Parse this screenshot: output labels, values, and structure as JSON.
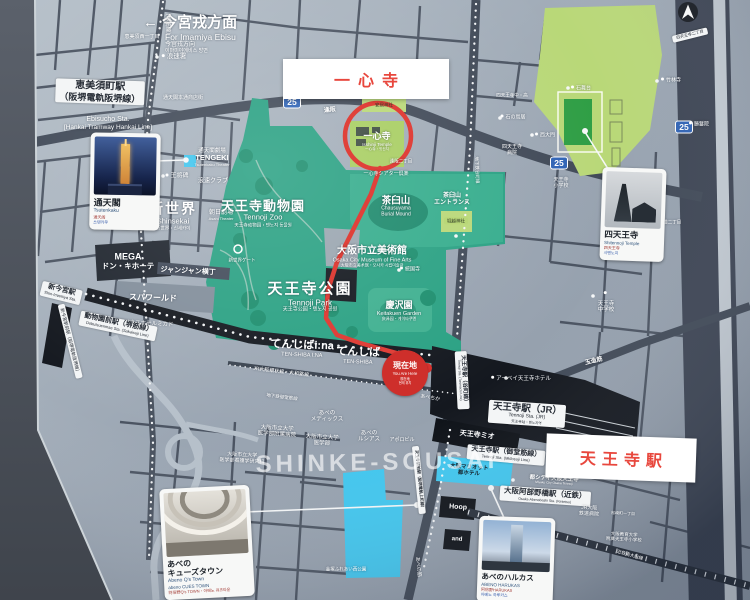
{
  "header": {
    "direction_jp": "← 今宮戎方面",
    "direction_en": "For Imamiya Ebisu",
    "direction_cn": "今宫戎方向",
    "direction_kr": "이마미야에비스 방면"
  },
  "callouts": {
    "isshinji": "一心寺",
    "tennoji": "天王寺駅"
  },
  "watermark": "SHINKE-SOUSAI",
  "route_shield": "25",
  "current_location": {
    "jp": "現在地",
    "en": "You Are Here",
    "cn": "现在地",
    "kr": "현재 위치"
  },
  "areas": {
    "zoo_jp": "天王寺動物園",
    "zoo_en": "Tennoji Zoo",
    "zoo_sub": "天王寺动物园・텐노지 동물원",
    "park_jp": "天王寺公園",
    "park_en": "Tennoji Park",
    "park_sub": "天王寺公园・텐노지 공원",
    "museum_jp": "大阪市立美術館",
    "museum_en": "Osaka City Museum of Fine Arts",
    "museum_sub": "大阪市立美术馆・오사카 시립미술관",
    "keitakuen_jp": "慶沢園",
    "keitakuen_en": "Keitakuen Garden",
    "keitakuen_sub": "庆泽园・게이타쿠엔",
    "chausuyama_jp": "茶臼山",
    "chausuyama_en1": "Chausuyama",
    "chausuyama_en2": "Burial Mound",
    "chausu_entrance1": "茶臼山",
    "chausu_entrance2": "エントランス",
    "tenshiba_ina_jp": "てんしばi:na",
    "tenshiba_ina_en": "TEN-SHIBA I:NA",
    "tenshiba_jp": "てんしば",
    "tenshiba_en": "TEN-SHIBA",
    "isshinji_jp": "一心寺",
    "isshinji_en": "Isshinji Temple",
    "isshinji_sub": "一心寺・잇신지",
    "shinsekai_jp": "新世界",
    "shinsekai_en": "Shinsekai",
    "shinsekai_sub": "新世界・신세카이"
  },
  "stations": {
    "ebisucho_jp1": "恵美須町駅",
    "ebisucho_jp2": "（阪堺電軌阪堺線）",
    "ebisucho_en1": "Ebisucho Sta.",
    "ebisucho_en2": "[Hankai Tramway Hankai Line]",
    "shinimamiya_jp": "新今宮駅",
    "shinimamiya_en": "Shin-Imamiya Sta.",
    "dobutsuenmae_jp": "動物園前駅（堺筋線）",
    "dobutsuenmae_en": "Dobutsuenmae Sta. (Sakaisuji Line)",
    "shinimamiya_ekimae": "新今宮駅前駅（阪堺電軌阪堺線）",
    "tanimachi_jp": "天王寺駅（谷町線）",
    "tanimachi_en": "Tennoji Sta. (Tanimachi Line)",
    "jr_jp": "天王寺駅（JR）",
    "jr_en": "Tennoji Sta. (JR)",
    "jr_sub": "天王寺站・텐노지역",
    "midosuji_jp": "天王寺駅（御堂筋線）",
    "midosuji_en": "Tennoji Sta. (Midosuji Line)",
    "uemachi": "天王寺駅前駅（阪堺電軌上町線）",
    "abenobashi_jp": "大阪阿部野橋駅（近鉄）",
    "abenobashi_en": "Osaka-Abenobashi Sta. (Kintetsu)"
  },
  "railways": {
    "jr": "JR大阪環状線・大和路線",
    "midosuji": "地下鉄御堂筋線",
    "tanimachi": "地下鉄谷町線",
    "sakaisuji": "（堺筋線）",
    "kintetsu": "近鉄南大阪線"
  },
  "roads": {
    "osakazaka": "逢阪",
    "tamatsukuri": "玉造筋",
    "abenosuji": "あべの筋"
  },
  "pois": {
    "naniwa_police": "浪速署",
    "hondori": "通天閣本通商店街",
    "theater1": "通天閣劇場",
    "theater2": "TENGEKI",
    "theater3": "Tsutenkaku Theater",
    "osho": "王将碑",
    "naniwa_club": "浪速クラブ",
    "asahi_jp": "朝日劇場",
    "asahi_en": "Asahi Theater",
    "mega1": "MEGA",
    "mega2": "ドン・キホーテ",
    "janjan": "ジャンジャン横丁",
    "spaworld": "スパワールド",
    "business_hotel": "ビジネスホテルミカド",
    "shinsekai_gate": "新世界ゲート",
    "isshinji_theater": "一心寺シアター倶楽",
    "yasui": "安居神社",
    "horikoshi": "堀越神社",
    "tokokuji": "統国寺",
    "abechika": "あべちか",
    "abey": "アーベイ天王寺ホテル",
    "mio": "天王寺ミオ",
    "marriott1": "大阪マリオット",
    "marriott2": "都ホテル",
    "miyako_city_jp": "都シティ大阪天王寺",
    "miyako_city_en": "Miyako City Osaka Tennoji",
    "hoop": "Hoop",
    "and": "and",
    "medix1": "あべの",
    "medix2": "メディックス",
    "lucias1": "あべの",
    "lucias2": "ルシアス",
    "apollo": "アポロビル",
    "hospital1": "大阪市立大学",
    "hospital2": "医学部附属病院",
    "univ1": "大阪市立大学",
    "univ2": "医学部",
    "nursing1": "大阪市立大学",
    "nursing2": "医学部看護学研究科",
    "jr_hospital1": "JR大阪",
    "jr_hospital2": "鉄道病院",
    "kyoiku1": "大阪教育大学",
    "kyoiku2": "附属天王寺小学校",
    "kanazuka": "金塚ふれあい西公園",
    "ishibutai": "石舞台",
    "saidaimon": "西大門",
    "stone_torii": "石の鳥居",
    "shitennoji_hosp1": "四天王寺",
    "shitennoji_hosp2": "病院",
    "shitennoji_hs": "四天王寺中・高",
    "chikurinji": "竹林寺",
    "shomanin": "勝鬘院",
    "tennoji_jhs1": "天王寺",
    "tennoji_jhs2": "中学校",
    "tennoji_es1": "天王寺",
    "tennoji_es2": "小学校"
  },
  "blocks": {
    "ebisu_nishi": "恵美須西一丁目",
    "osaka2": "逢阪二丁目",
    "shitennoji2": "四天王寺二丁目",
    "daido2": "大道二丁目",
    "matsuzaki": "松崎町一丁目"
  },
  "cards": {
    "tsutenkaku": {
      "title": "通天閣",
      "en": "Tsutenkaku",
      "cn": "通天阁",
      "kr": "쓰텐카쿠"
    },
    "shitennoji": {
      "title": "四天王寺",
      "en": "Shitennoji Temple",
      "cn": "四天王寺",
      "kr": "시텐노지"
    },
    "qstown": {
      "title1": "あべの",
      "title2": "キューズタウン",
      "en1": "Abeno Q's Town",
      "en2": "abeno CUES TOWN",
      "sub": "阿倍野Q's TOWN・아베노 큐즈타운"
    },
    "harukas": {
      "title": "あべのハルカス",
      "en": "ABENO HARUKAS",
      "cn": "阿倍野HARUKAS",
      "kr": "아베노 하루카스"
    }
  },
  "colors": {
    "accent_red": "#e0413a",
    "park_green": "#2aa183",
    "temple_green": "#b9d878",
    "cyan": "#41c6ee"
  }
}
